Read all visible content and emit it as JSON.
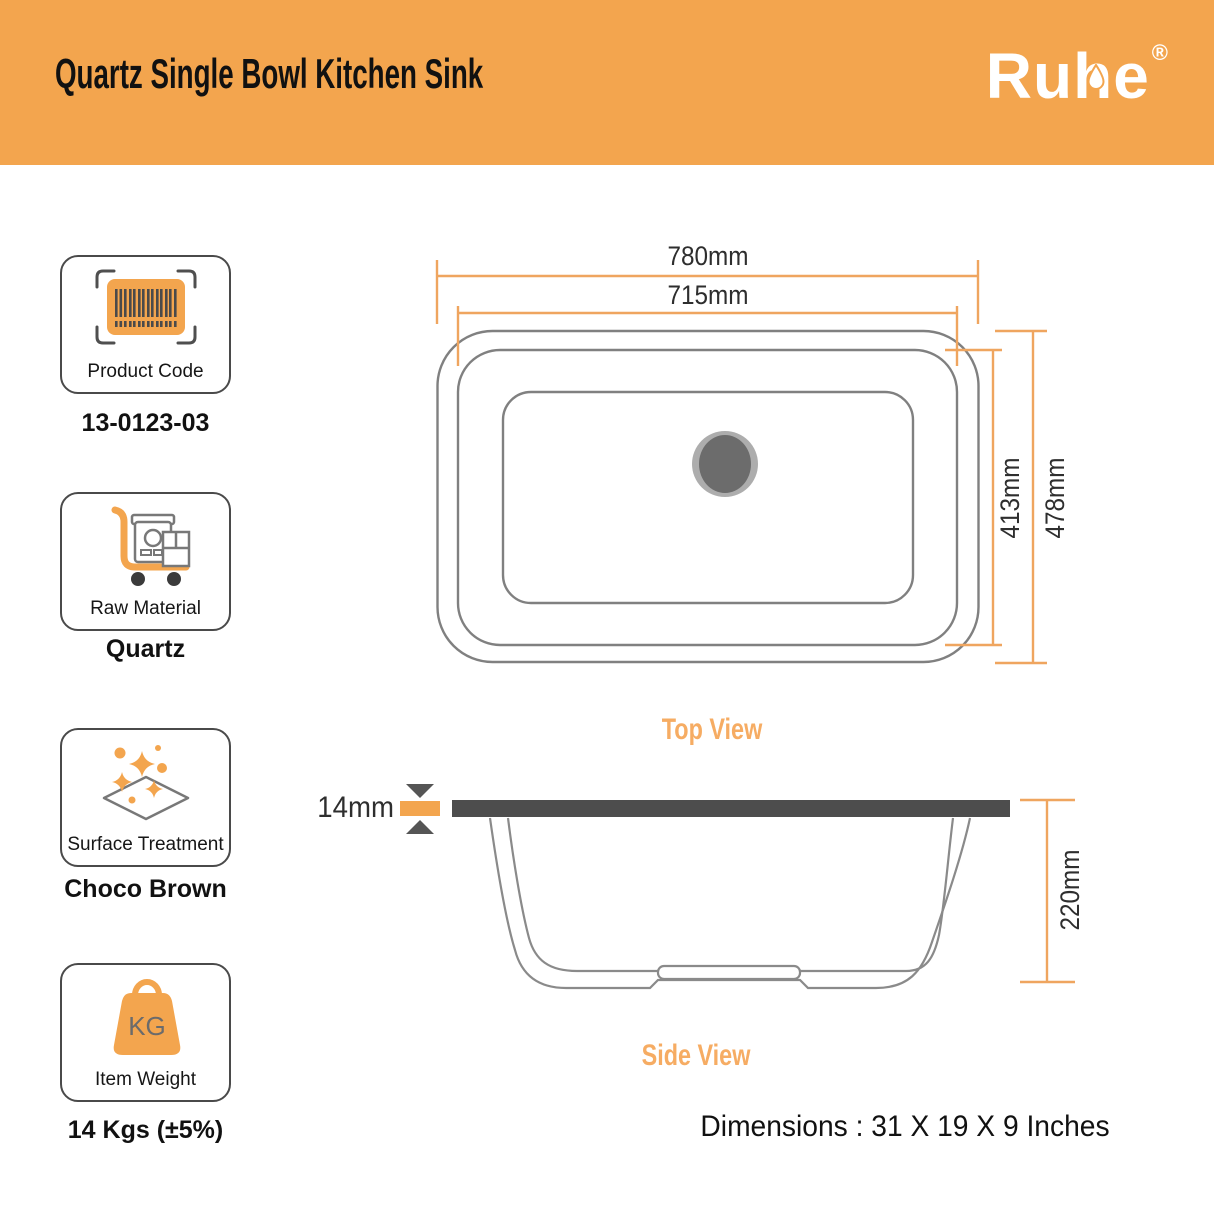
{
  "header": {
    "title": "Quartz Single Bowl Kitchen Sink",
    "brand": "Ruhe",
    "registered_mark": "®"
  },
  "specs": [
    {
      "label": "Product Code",
      "value": "13-0123-03",
      "icon": "barcode-icon"
    },
    {
      "label": "Raw Material",
      "value": "Quartz",
      "icon": "material-trolley-icon"
    },
    {
      "label": "Surface Treatment",
      "value": "Choco Brown",
      "icon": "sparkle-diamond-icon"
    },
    {
      "label": "Item Weight",
      "value": "14 Kgs (±5%)",
      "icon": "weight-kg-icon",
      "icon_text": "KG"
    }
  ],
  "diagram": {
    "top_view": {
      "label": "Top View",
      "outer_width": "780mm",
      "inner_width": "715mm",
      "inner_height": "413mm",
      "outer_height": "478mm"
    },
    "side_view": {
      "label": "Side View",
      "rim_thickness": "14mm",
      "bowl_depth": "220mm"
    },
    "footer_dimensions": "Dimensions : 31 X 19 X 9 Inches"
  },
  "colors": {
    "accent_orange": "#F3A54E",
    "dimension_orange": "#EFA55F",
    "view_label_orange": "#F6AC63",
    "sink_line_gray": "#808080",
    "dark_gray": "#4D4D4D",
    "drain_outer_gray": "#ADADAD",
    "drain_inner_gray": "#6C6C6C"
  }
}
